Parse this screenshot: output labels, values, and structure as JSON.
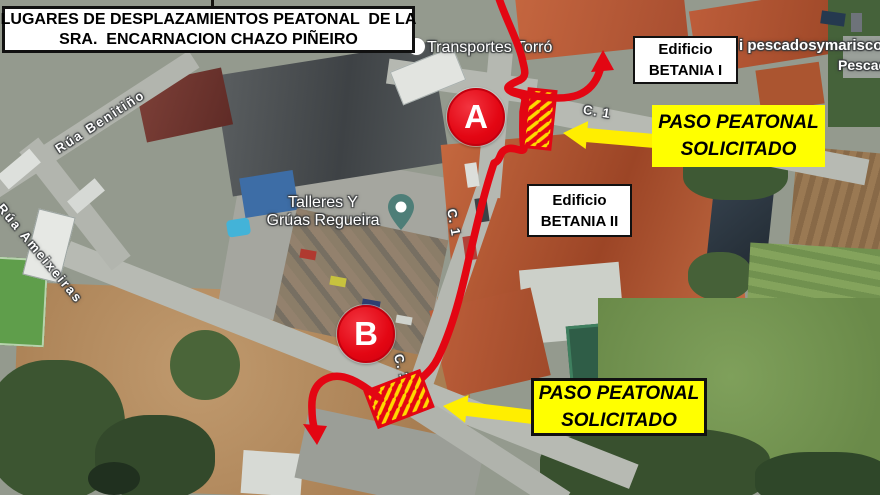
{
  "title_card": {
    "line1": "LUGARES DE DESPLAZAMIENTOS PEATONAL  DE LA",
    "line2": "SRA.  ENCARNACION CHAZO PIÑEIRO"
  },
  "building_labels": {
    "betania1": {
      "line1": "Edificio",
      "line2": "BETANIA I"
    },
    "betania2": {
      "line1": "Edificio",
      "line2": "BETANIA II"
    }
  },
  "callouts": {
    "paso_top": {
      "line1": "PASO PEATONAL",
      "line2": "SOLICITADO"
    },
    "paso_bottom": {
      "line1": "PASO PEATONAL",
      "line2": "SOLICITADO"
    }
  },
  "route_markers": {
    "a": "A",
    "b": "B"
  },
  "map_labels": {
    "transportes": "Transportes Torró",
    "talleres_line1": "Talleres Y",
    "talleres_line2": "Grúas Regueira",
    "rua_benitino": "Rúa Benitiño",
    "rua_ameixeiras": "Rúa Ameixeiras",
    "c1": "C. 1",
    "pescados_line1": "i pescadosymarisco",
    "pescados_line2": "Pescado"
  },
  "colors": {
    "route_red": "#e30613",
    "callout_yellow": "#ffff00",
    "hatch_yellow": "#ffd800",
    "hatch_red": "#e30613"
  }
}
